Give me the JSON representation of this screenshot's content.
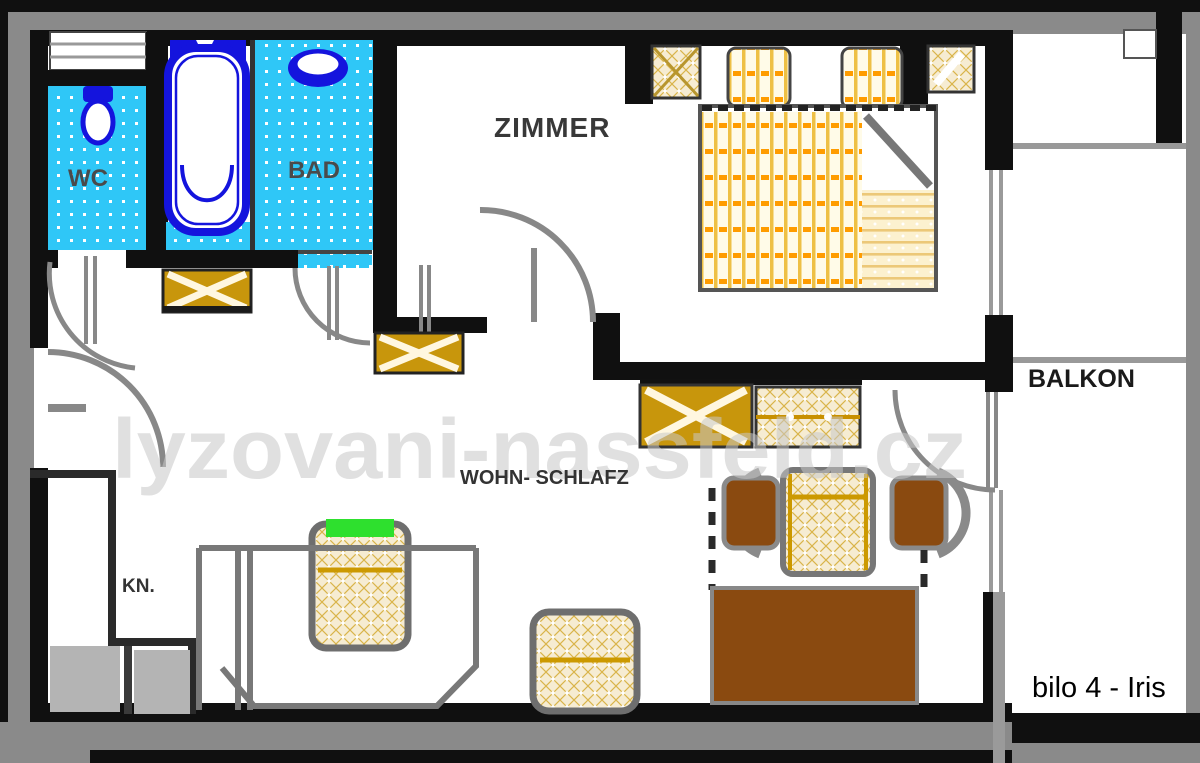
{
  "rooms": {
    "wc": {
      "label": "WC"
    },
    "bad": {
      "label": "BAD"
    },
    "zimmer": {
      "label": "ZIMMER"
    },
    "balkon": {
      "label": "BALKON"
    },
    "wohn_schlafz": {
      "label": "WOHN- SCHLAFZ"
    },
    "kn": {
      "label": "KN."
    }
  },
  "caption": {
    "unit_label": "bilo 4 - Iris"
  },
  "watermark": {
    "text": "lyzovani-nassfeld.cz"
  },
  "palette": {
    "wall": "#101010",
    "outer_gray": "#8a8a8a",
    "tile_cyan": "#2fc7f7",
    "fixture_blue": "#1414dd",
    "gold": "#c8960c",
    "hatch_cream": "#f6ecd2",
    "bed_yellow": "#eec045",
    "orange": "#ff9c00",
    "brown": "#8a4a10",
    "green": "#2ee02e",
    "label_gray": "#4a4a4a",
    "watermark_gray": "#c8c8c8",
    "door_gray": "#888888",
    "counter_gray": "#b4b4b4"
  }
}
